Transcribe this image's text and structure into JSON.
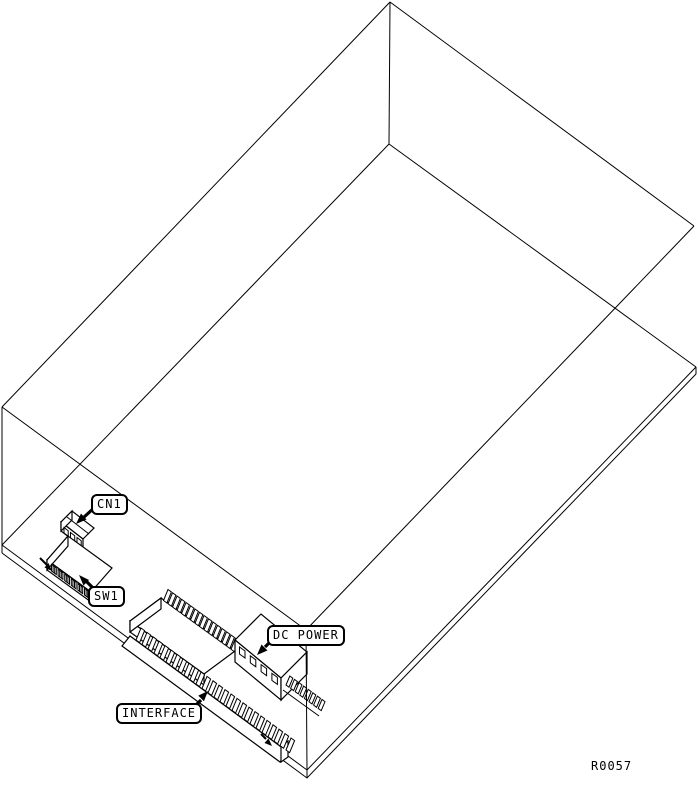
{
  "figure": {
    "reference_number": "R0057",
    "colors": {
      "background": "#ffffff",
      "line": "#000000"
    },
    "callouts": [
      {
        "id": "cn1",
        "label": "CN1"
      },
      {
        "id": "sw1",
        "label": "SW1"
      },
      {
        "id": "dc_power",
        "label": "DC POWER"
      },
      {
        "id": "interface",
        "label": "INTERFACE"
      }
    ]
  }
}
